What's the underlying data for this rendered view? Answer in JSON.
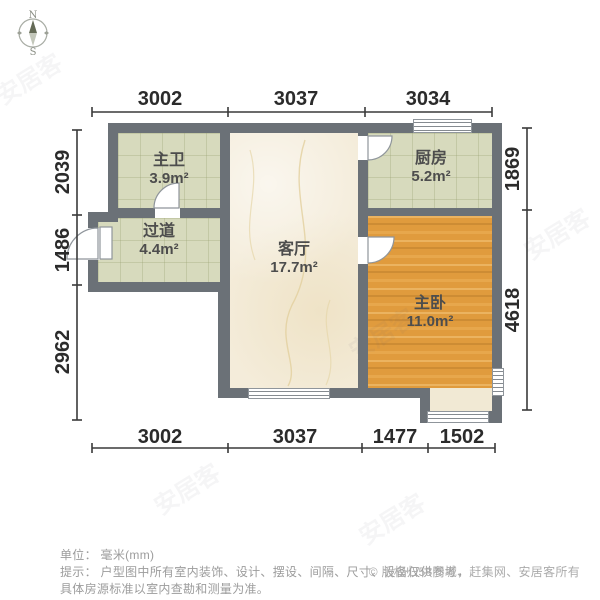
{
  "compass": {
    "north": "N",
    "south": "S"
  },
  "dimensions": {
    "top": [
      "3002",
      "3037",
      "3034"
    ],
    "bottom": [
      "3002",
      "3037",
      "1477",
      "1502"
    ],
    "left": [
      "2039",
      "1486",
      "2962"
    ],
    "right": [
      "1869",
      "4618"
    ]
  },
  "rooms": {
    "bathroom": {
      "name": "主卫",
      "area": "3.9m²"
    },
    "kitchen": {
      "name": "厨房",
      "area": "5.2m²"
    },
    "hallway": {
      "name": "过道",
      "area": "4.4m²"
    },
    "living": {
      "name": "客厅",
      "area": "17.7m²"
    },
    "bedroom": {
      "name": "主卧",
      "area": "11.0m²"
    }
  },
  "footer": {
    "unit_line": "单位： 毫米(mm)",
    "tip_line1": "提示： 户型图中所有室内装饰、设计、摆设、间隔、尺寸、设备仅供参考，",
    "tip_line2": "具体房源标准以室内查勘和测量为准。",
    "copyright": "© 版权归58同城、赶集网、安居客所有"
  },
  "watermark": {
    "text": "安居客"
  },
  "colors": {
    "wall": "#6b7177",
    "tile_floor": "#d7dabd",
    "marble_floor": "#f4ecda",
    "wood_floor": "#e09b3d",
    "balcony_floor": "#f1e9d4",
    "dimension_text": "#2b2b2b",
    "room_label": "#4d4d4d",
    "footer_text": "#9c9c9c"
  }
}
